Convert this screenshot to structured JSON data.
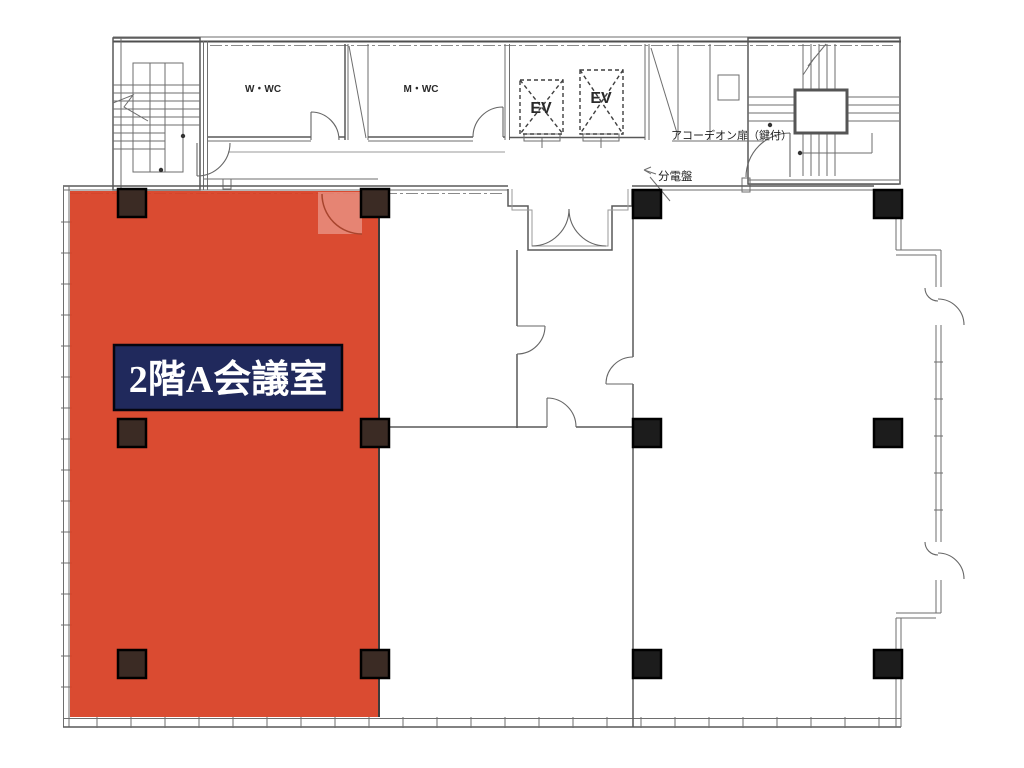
{
  "plan": {
    "rooms": {
      "womens_wc_label": "W・WC",
      "mens_wc_label": "M・WC",
      "elevator_left_label": "EV",
      "elevator_right_label": "EV"
    },
    "annotations": {
      "accordion_door": "アコーデオン扉（鍵付）",
      "distribution_board": "分電盤"
    },
    "highlight": {
      "room_label": "2階A会議室",
      "area_color": "#d84126",
      "label_bg_color": "#20295c",
      "label_text_color": "#ffffff"
    },
    "colors": {
      "column": "#1c1c1c",
      "column_tinted": "#3b2b24",
      "wall_line": "#585858"
    }
  }
}
